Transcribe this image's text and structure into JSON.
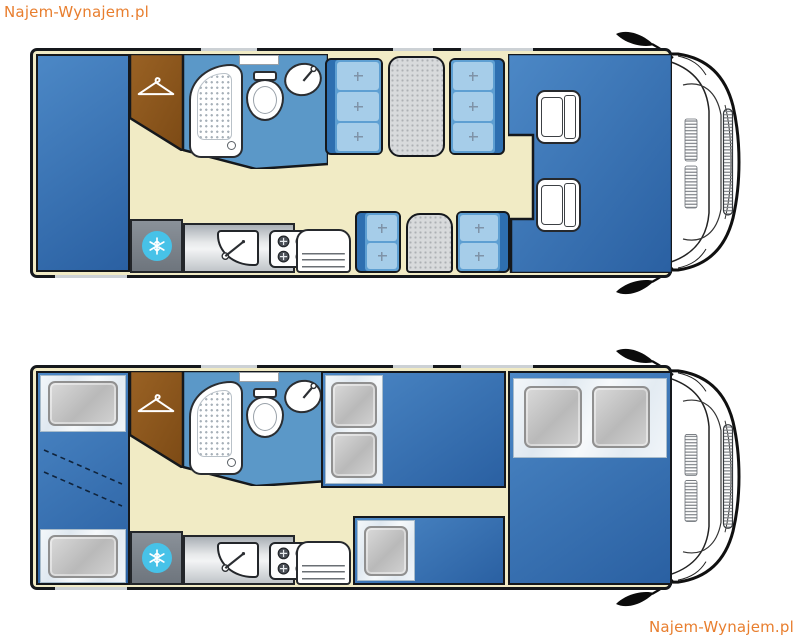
{
  "brand": {
    "watermark_top_left": "Najem-Wynajem.pl",
    "watermark_bottom_right": "Najem-Wynajem.pl"
  },
  "colors": {
    "brand_orange": "#E87E2E",
    "outline": "#15181C",
    "floor_cream": "#F1EBC5",
    "block_blue_light": "#4C88C6",
    "block_blue_dark": "#2A60A2",
    "bathroom_blue": "#5B98C8",
    "cushion_light": "#A6CDE9",
    "cushion_mid": "#5E9FD2",
    "backrest_blue": "#2E6FB0",
    "wardrobe_brown_light": "#9A6224",
    "wardrobe_brown_dark": "#7C4A15",
    "kitchen_gray": "#C9CDD0",
    "fridge_gray": "#7D848C",
    "freezer_cyan": "#47C2E8",
    "table_gray": "#D8DADC",
    "bedding_white": "#EFF3F7",
    "pillow_gray": "#C8C8C8"
  },
  "diagram": {
    "type": "motorhome-floor-plans-top-view",
    "plans": [
      {
        "id": "day-layout",
        "features": [
          "rear-double-bed",
          "wardrobe-with-hanger",
          "shower",
          "toilet",
          "washbasin",
          "dinette-4-seats-with-table",
          "side-dinette-2-seats-with-table",
          "fridge-freezer",
          "kitchen-sink",
          "gas-hob-4-burners",
          "bench-seat",
          "swivel-cab-seats",
          "driver-cab",
          "side-mirrors"
        ]
      },
      {
        "id": "night-layout",
        "features": [
          "rear-bunk-beds",
          "wardrobe-with-hanger",
          "shower",
          "toilet",
          "washbasin",
          "dinette-converted-double-bed",
          "side-single-bed",
          "drop-down-front-double-bed",
          "fridge-freezer",
          "kitchen-sink",
          "gas-hob-4-burners",
          "bench-seat",
          "driver-cab",
          "side-mirrors"
        ]
      }
    ]
  }
}
